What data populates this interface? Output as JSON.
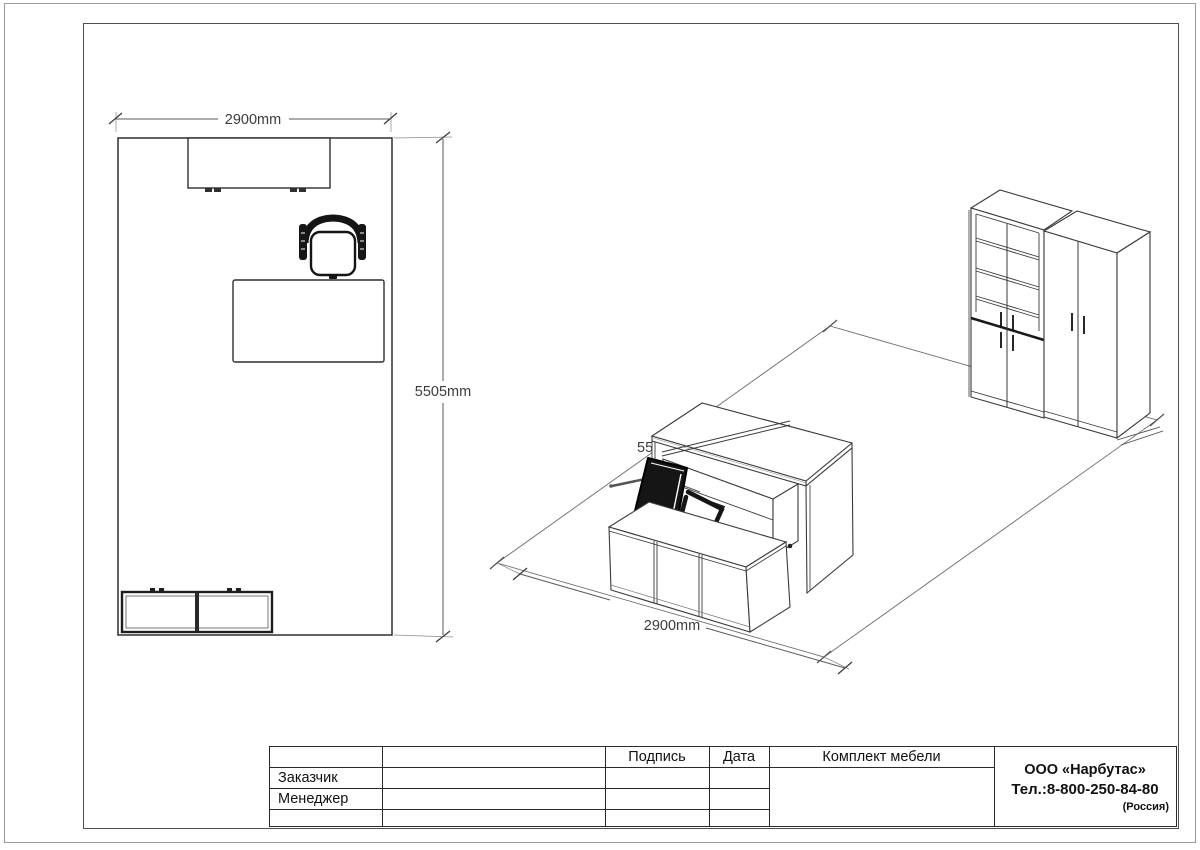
{
  "plan": {
    "width_label": "2900mm",
    "height_label": "5505mm"
  },
  "iso": {
    "width_label": "2900mm",
    "depth_label": "5505mm"
  },
  "title_block": {
    "signature_header": "Подпись",
    "date_header": "Дата",
    "customer_label": "Заказчик",
    "manager_label": "Менеджер",
    "project_title": "Комплект мебели",
    "company_name": "ООО «Нарбутас»",
    "company_phone": "Тел.:8-800-250-84-80",
    "company_country": "(Россия)"
  },
  "colors": {
    "drawing_line": "#3a3a3a",
    "dimension_line": "#5a5a5a",
    "chair_black": "#151515",
    "table_line": "#2b2b2b",
    "frame_line": "#4f4f4f"
  }
}
